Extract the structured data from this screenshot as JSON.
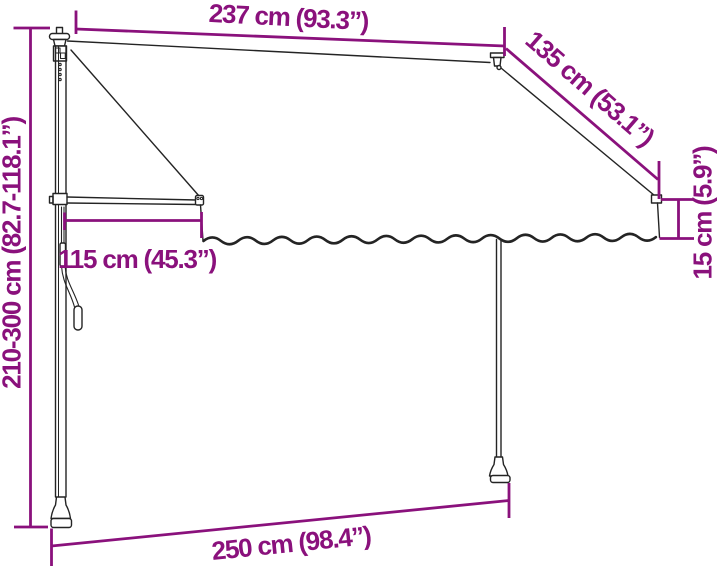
{
  "canvas": {
    "width": 720,
    "height": 567,
    "background": "#ffffff"
  },
  "style": {
    "dimension_color": "#8A117C",
    "line_color": "#242424"
  },
  "dimensions": {
    "top_width": "237 cm (93.3”)",
    "side_slant": "135 cm (53.1”)",
    "valance_height": "15 cm (5.9”)",
    "arm_projection": "115 cm (45.3”)",
    "pole_height": "210-300 cm (82.7-118.1”)",
    "base_width": "250 cm (98.4”)"
  }
}
